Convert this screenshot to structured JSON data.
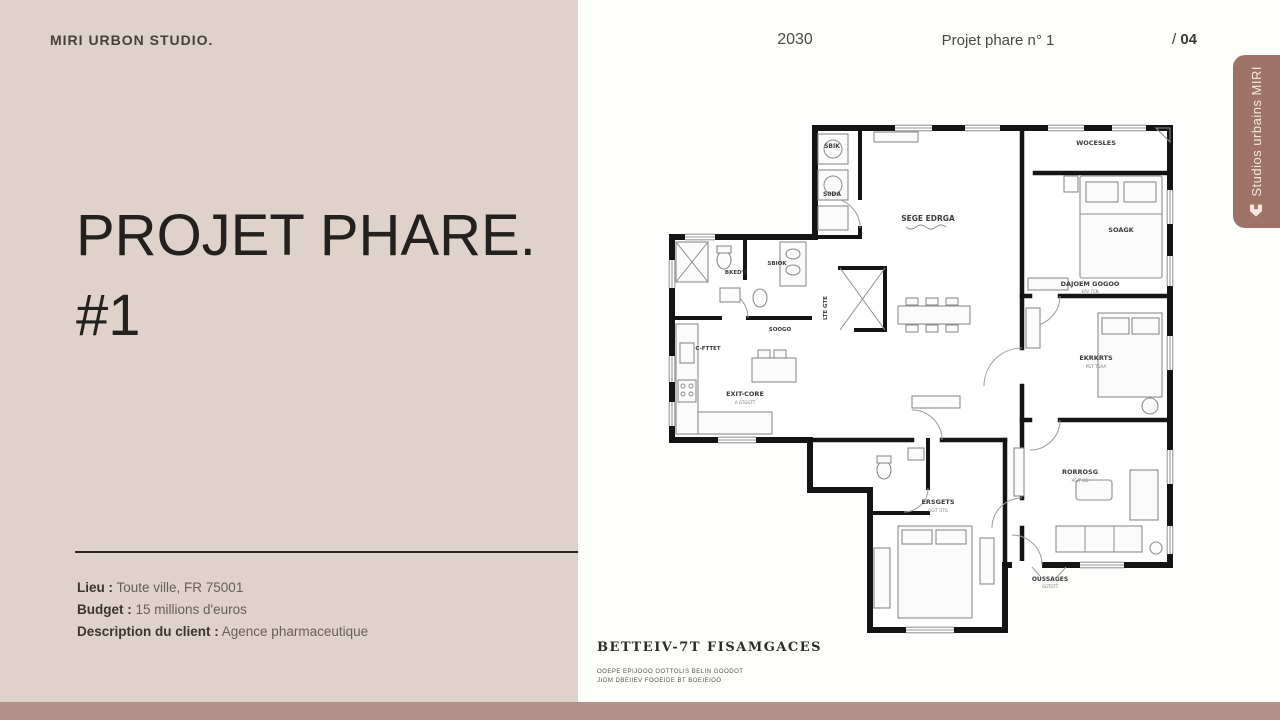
{
  "colors": {
    "left_panel": "#ded2ca",
    "right_panel": "#fdfdfb",
    "bottom_bar": "#b2938a",
    "tab": "#9f7466",
    "tab_text": "#f3e9dd",
    "ink": "#23201d"
  },
  "header": {
    "brand": "MIRI URBON STUDIO.",
    "year": "2030",
    "center_title": "Projet phare n° 1",
    "page_prefix": "/ ",
    "page_number": "04"
  },
  "title": {
    "line1": "PROJET PHARE.",
    "line2": "#1"
  },
  "details": [
    {
      "label": "Lieu :",
      "value": " Toute ville, FR 75001"
    },
    {
      "label": "Budget :",
      "value": " 15 millions d'euros"
    },
    {
      "label": "Description du client :",
      "value": " Agence pharmaceutique"
    }
  ],
  "tab": {
    "label": "Studios urbains MIRI",
    "icon": "home-icon"
  },
  "plan": {
    "labels": [
      "SBIK",
      "S0DA",
      "SEGE EDRGA",
      "WOCESLES",
      "SOAGK",
      "DAJOEM GOGOO",
      "EAV TCN",
      "EKRKRTS",
      "PGT TGAA",
      "RORROSG",
      "AGIT GG",
      "ERSGETS",
      "GGIT GTG",
      "EXIT-CORE",
      "A GTGGTT",
      "C-FTTET",
      "BKED'T",
      "SBIOK",
      "SOOGO",
      "LTE GTE",
      "OUSSAGES",
      "GGTGTT"
    ]
  },
  "caption": {
    "title": "BETTEIV-7T FISAMGACES",
    "line1": "OOEPE EPIJOOO   OOTTOLIS BELIN   GOODOT",
    "line2": "JIOM DBEIIEV      FOOEIDE BT BOEIEIOO"
  }
}
